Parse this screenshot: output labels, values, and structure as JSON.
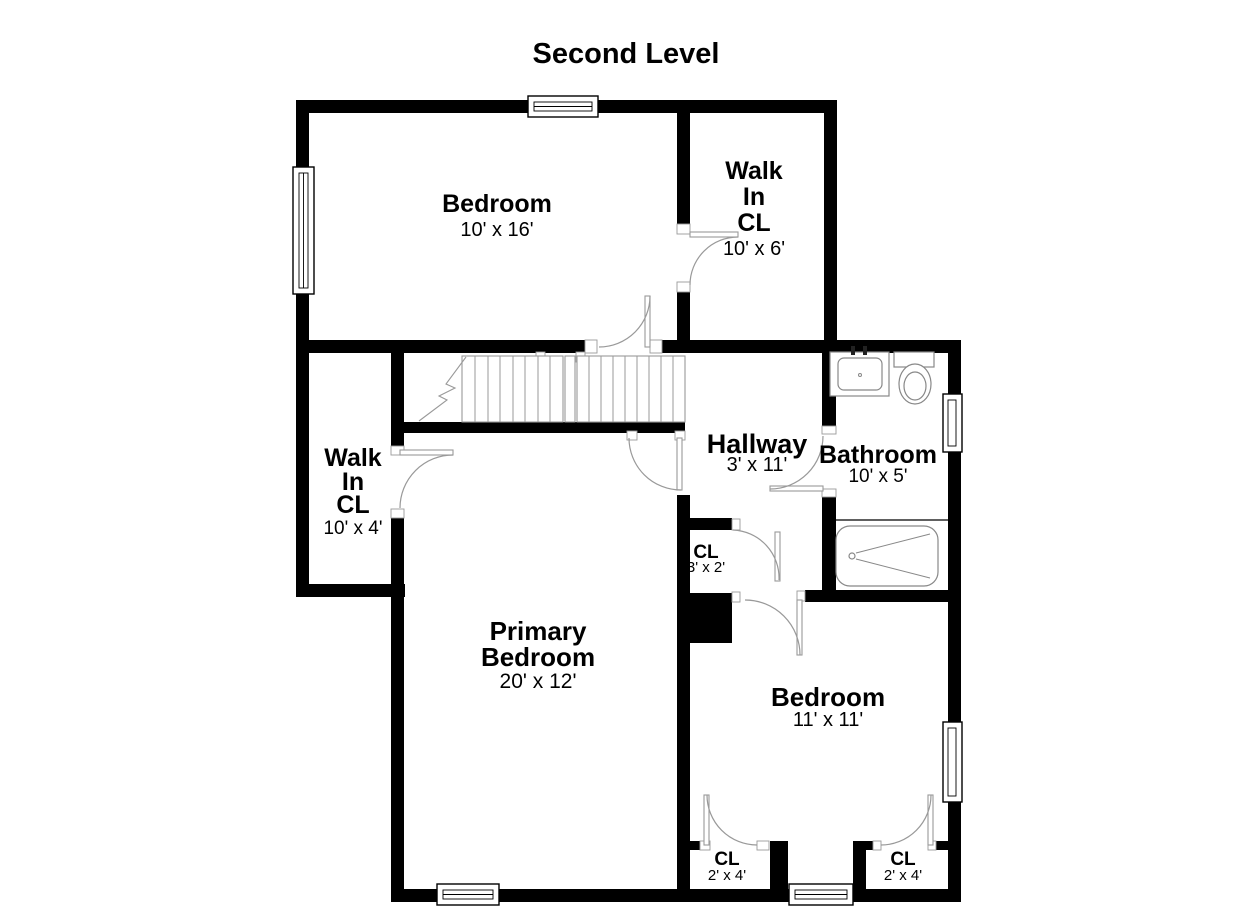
{
  "title": "Second Level",
  "colors": {
    "wall": "#000000",
    "door_line": "#999999",
    "fixture_line": "#888888",
    "background": "#ffffff",
    "text": "#000000"
  },
  "rooms": {
    "bedroom_top": {
      "name": "Bedroom",
      "dims": "10' x 16'"
    },
    "walkin_top": {
      "l1": "Walk",
      "l2": "In",
      "l3": "CL",
      "dims": "10' x 6'"
    },
    "walkin_left": {
      "l1": "Walk",
      "l2": "In",
      "l3": "CL",
      "dims": "10' x 4'"
    },
    "hallway": {
      "name": "Hallway",
      "dims": "3' x 11'"
    },
    "bathroom": {
      "name": "Bathroom",
      "dims": "10' x 5'"
    },
    "closet_hall": {
      "name": "CL",
      "dims": "3' x 2'"
    },
    "primary": {
      "l1": "Primary",
      "l2": "Bedroom",
      "dims": "20' x 12'"
    },
    "bedroom_right": {
      "name": "Bedroom",
      "dims": "11' x 11'"
    },
    "closet_bottom_left": {
      "name": "CL",
      "dims": "2' x 4'"
    },
    "closet_bottom_right": {
      "name": "CL",
      "dims": "2' x 4'"
    }
  },
  "fixtures": [
    "staircase",
    "sink",
    "toilet",
    "bathtub"
  ]
}
